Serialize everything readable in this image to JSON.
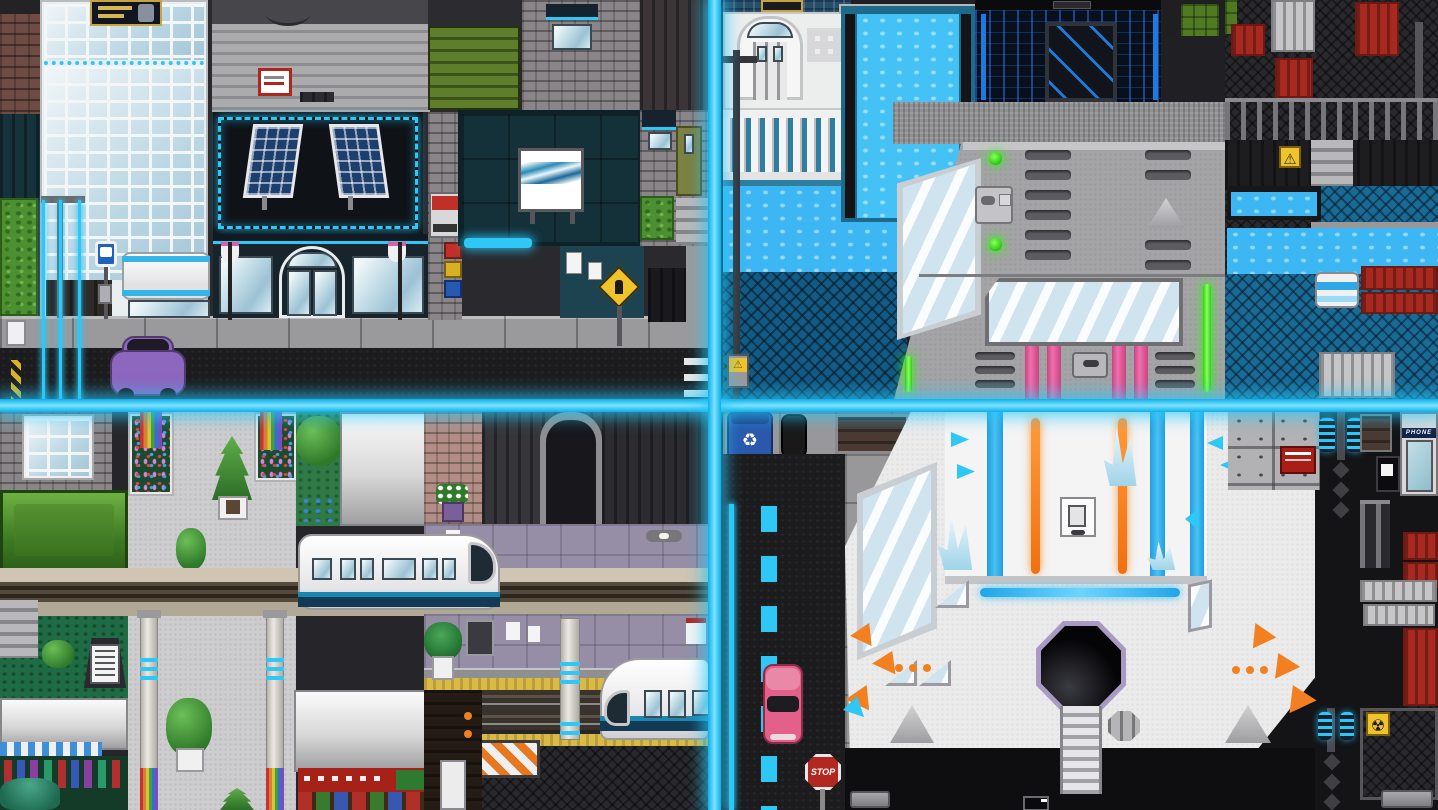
{
  "meta": {
    "type": "game-screenshot",
    "style": "pixel-art sci-fi city tileset collage",
    "grid": "2x2"
  },
  "labels": {
    "stop_sign": "STOP",
    "phone_booth_sign": "PHONE"
  },
  "icons": [
    "bus-icon",
    "pedestrian-crossing-icon",
    "warning-icon",
    "radiation-icon",
    "recycle-icon",
    "wave-art-icon"
  ],
  "palette": {
    "cyan": "#2fc7f5",
    "water": "#3cb7f3",
    "water_deep": "#135a84",
    "orange": "#f28020",
    "pink": "#dd4f98",
    "container_red": "#a8291f",
    "green_light": "#3ce619",
    "platform_yellow": "#d9ba45",
    "stop_red": "#b22820",
    "bin_blue": "#2b58ac",
    "car_pink": "#e3608a",
    "car_purple": "#8d66bd",
    "sign_yellow": "#eec32c",
    "train_teal": "#1a7ea8"
  }
}
